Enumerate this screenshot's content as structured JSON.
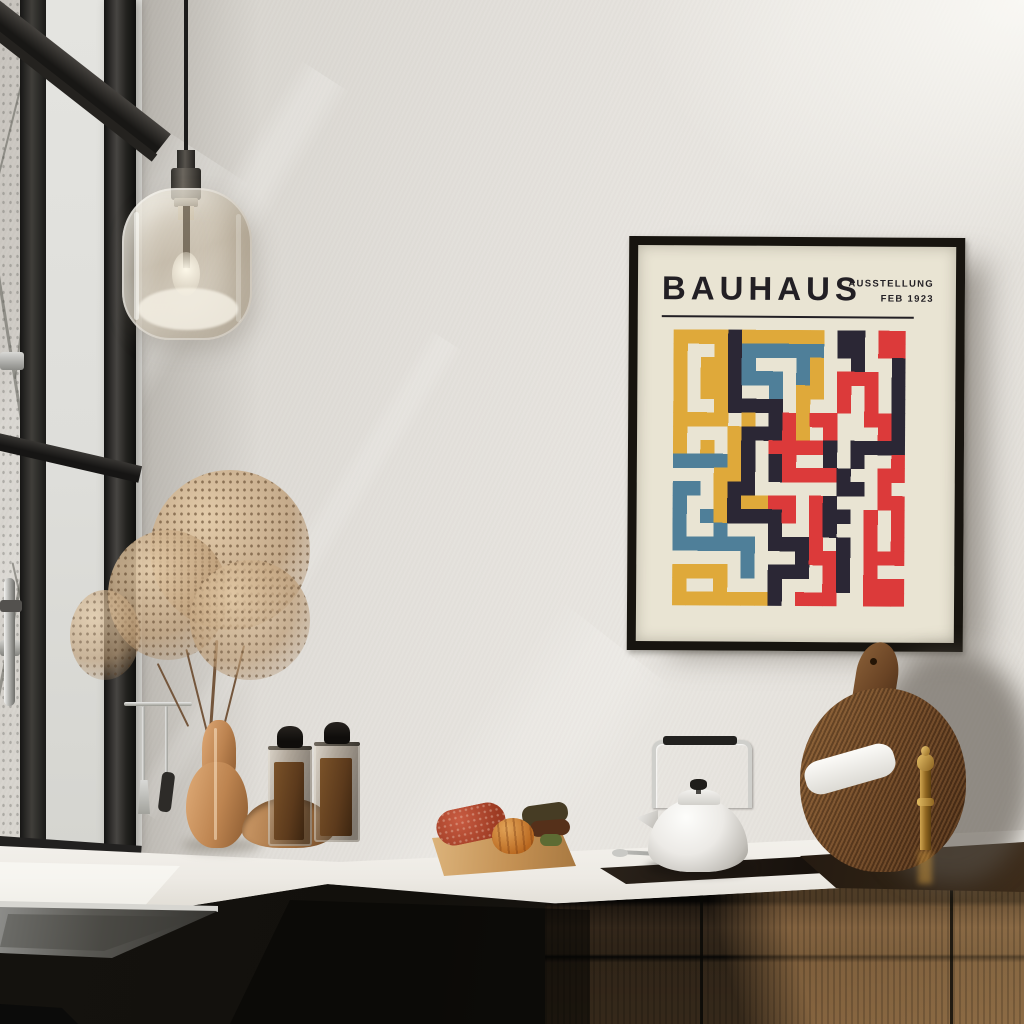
{
  "poster": {
    "title": "BAUHAUS",
    "info_line1": "AUSSTELLUNG",
    "info_line2": "FEB 1923",
    "colors": {
      "paper": "#e9e4d3",
      "frame": "#17140f",
      "ink": "#221f24",
      "yellow": "#dfa93a",
      "red": "#dc3a3a",
      "blue": "#4f7f99",
      "navy": "#2b2735"
    },
    "artwork": {
      "palette": {
        "Y": "#dfa93a",
        "R": "#dc3a3a",
        "B": "#4f7f99",
        "N": "#2b2735"
      },
      "rows": [
        "YYYYNYYYYYY.NN.RR",
        "Y..YNBBBBBB.NN.RR",
        "Y.YYNB...BY..N..N",
        "Y.YYNBBB.BY.RRR.N",
        "Y.YYN..B.YY.R.R.N",
        "Y..YNNNN.Y..R.R.N",
        "YYYY.Y.NRYRR..RRN",
        "Y...YNNNRY.R...RN",
        "Y.Y.YN.RRRRN.NNNN",
        "BBBBYN.NR..N.N..R",
        "...YYN.NRRRRN..RR",
        "BB.YNN......NN.R.",
        "B..YNYYRR.RN...RR",
        "B.BYNNNNR.RNN.R.R",
        "B..B...N..RN..R.R",
        "BBBBBB.NNNR.N.R.R",
        ".....B...NRRN.RRR",
        "YYYY.B.NNN.RN.R..",
        "Y..Y...N...RN.RRR",
        "YYYYYYYN.RRR..RRR"
      ]
    }
  }
}
